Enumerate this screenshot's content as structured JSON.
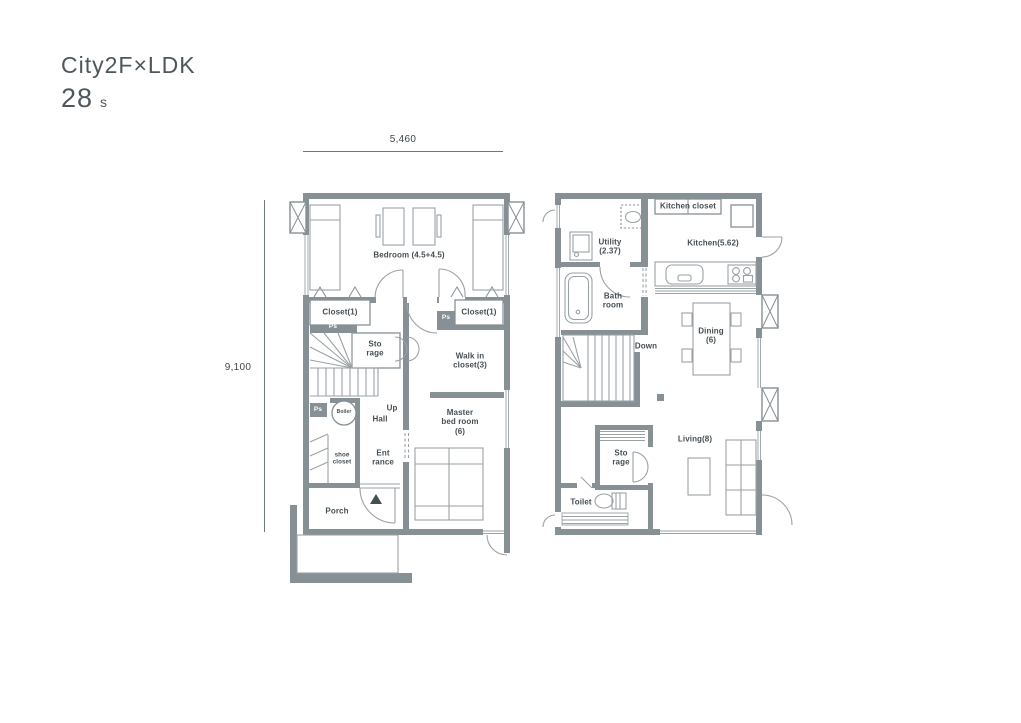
{
  "title": {
    "name": "City2F×LDK",
    "area_value": "28",
    "area_unit": "s"
  },
  "dimensions": {
    "width_mm": "5,460",
    "height_mm": "9,100"
  },
  "floor_left": {
    "bedroom": "Bedroom  (4.5+4.5)",
    "closet_left": "Closet(1)",
    "closet_right": "Closet(1)",
    "pipe_space": "Ps",
    "storage": "Sto\nrage",
    "stairs_up": "Up",
    "walk_in_closet": "Walk in\ncloset(3)",
    "hall": "Hall",
    "boiler": "Boiler",
    "master_bedroom": "Master\nbed room\n(6)",
    "shoe_closet": "shoe\ncloset",
    "entrance": "Ent\nrance",
    "porch": "Porch"
  },
  "floor_right": {
    "utility": "Utility\n(2.37)",
    "bathroom": "Bath\nroom",
    "kitchen_closet": "Kitchen closet",
    "kitchen": "Kitchen(5.62)",
    "stairs_down": "Down",
    "dining": "Dining\n(6)",
    "living": "Living(8)",
    "storage": "Sto\nrage",
    "toilet": "Toilet"
  },
  "colors": {
    "wall": "#879094",
    "furniture_line": "#9aa2a5",
    "label_text": "#454e53"
  }
}
